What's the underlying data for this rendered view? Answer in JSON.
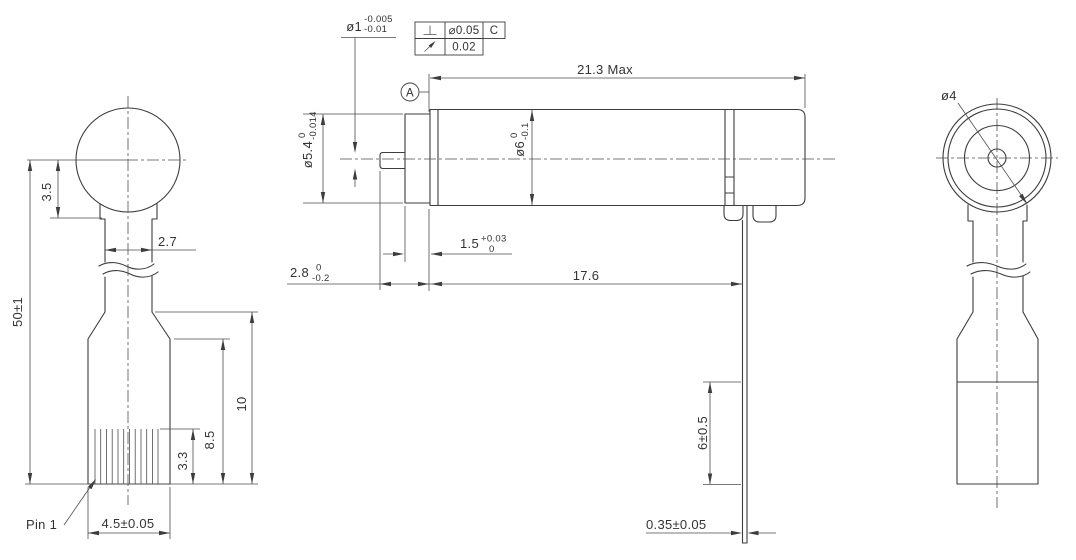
{
  "colors": {
    "background": "#ffffff",
    "line": "#3d3d3d",
    "text": "#333333"
  },
  "views": {
    "front": {
      "dims": {
        "ball_offset": "3.5",
        "neck_width": "2.7",
        "overall_length": "50±1",
        "connector_upper": "8.5",
        "connector_total": "10",
        "pin_exposed": "3.3",
        "connector_width": "4.5±0.05",
        "pin1_label": "Pin 1"
      }
    },
    "side": {
      "shaft_dia": {
        "value": "ø1",
        "upper": "-0.005",
        "lower": "-0.01"
      },
      "gdt": {
        "row1": {
          "symbol_icon": "perpendicularity-icon",
          "tolerance": "⌀0.05",
          "datum": "C"
        },
        "row2": {
          "symbol_icon": "circular-runout-icon",
          "tolerance": "0.02"
        },
        "datum_label": "A"
      },
      "dims": {
        "max_length": "21.3 Max",
        "boss_dia": {
          "value": "ø5.4",
          "upper": "0",
          "lower": "-0.014"
        },
        "body_dia": {
          "value": "ø6",
          "upper": "0",
          "lower": "-0.1"
        },
        "boss_length": {
          "value": "1.5",
          "upper": "+0.03",
          "lower": "0"
        },
        "shaft_extension": {
          "value": "2.8",
          "upper": "0",
          "lower": "-0.2"
        },
        "body_length": "17.6",
        "terminal_length": "6±0.5",
        "terminal_thickness": "0.35±0.05"
      }
    },
    "end": {
      "dims": {
        "inner_dia": "ø4"
      }
    }
  }
}
